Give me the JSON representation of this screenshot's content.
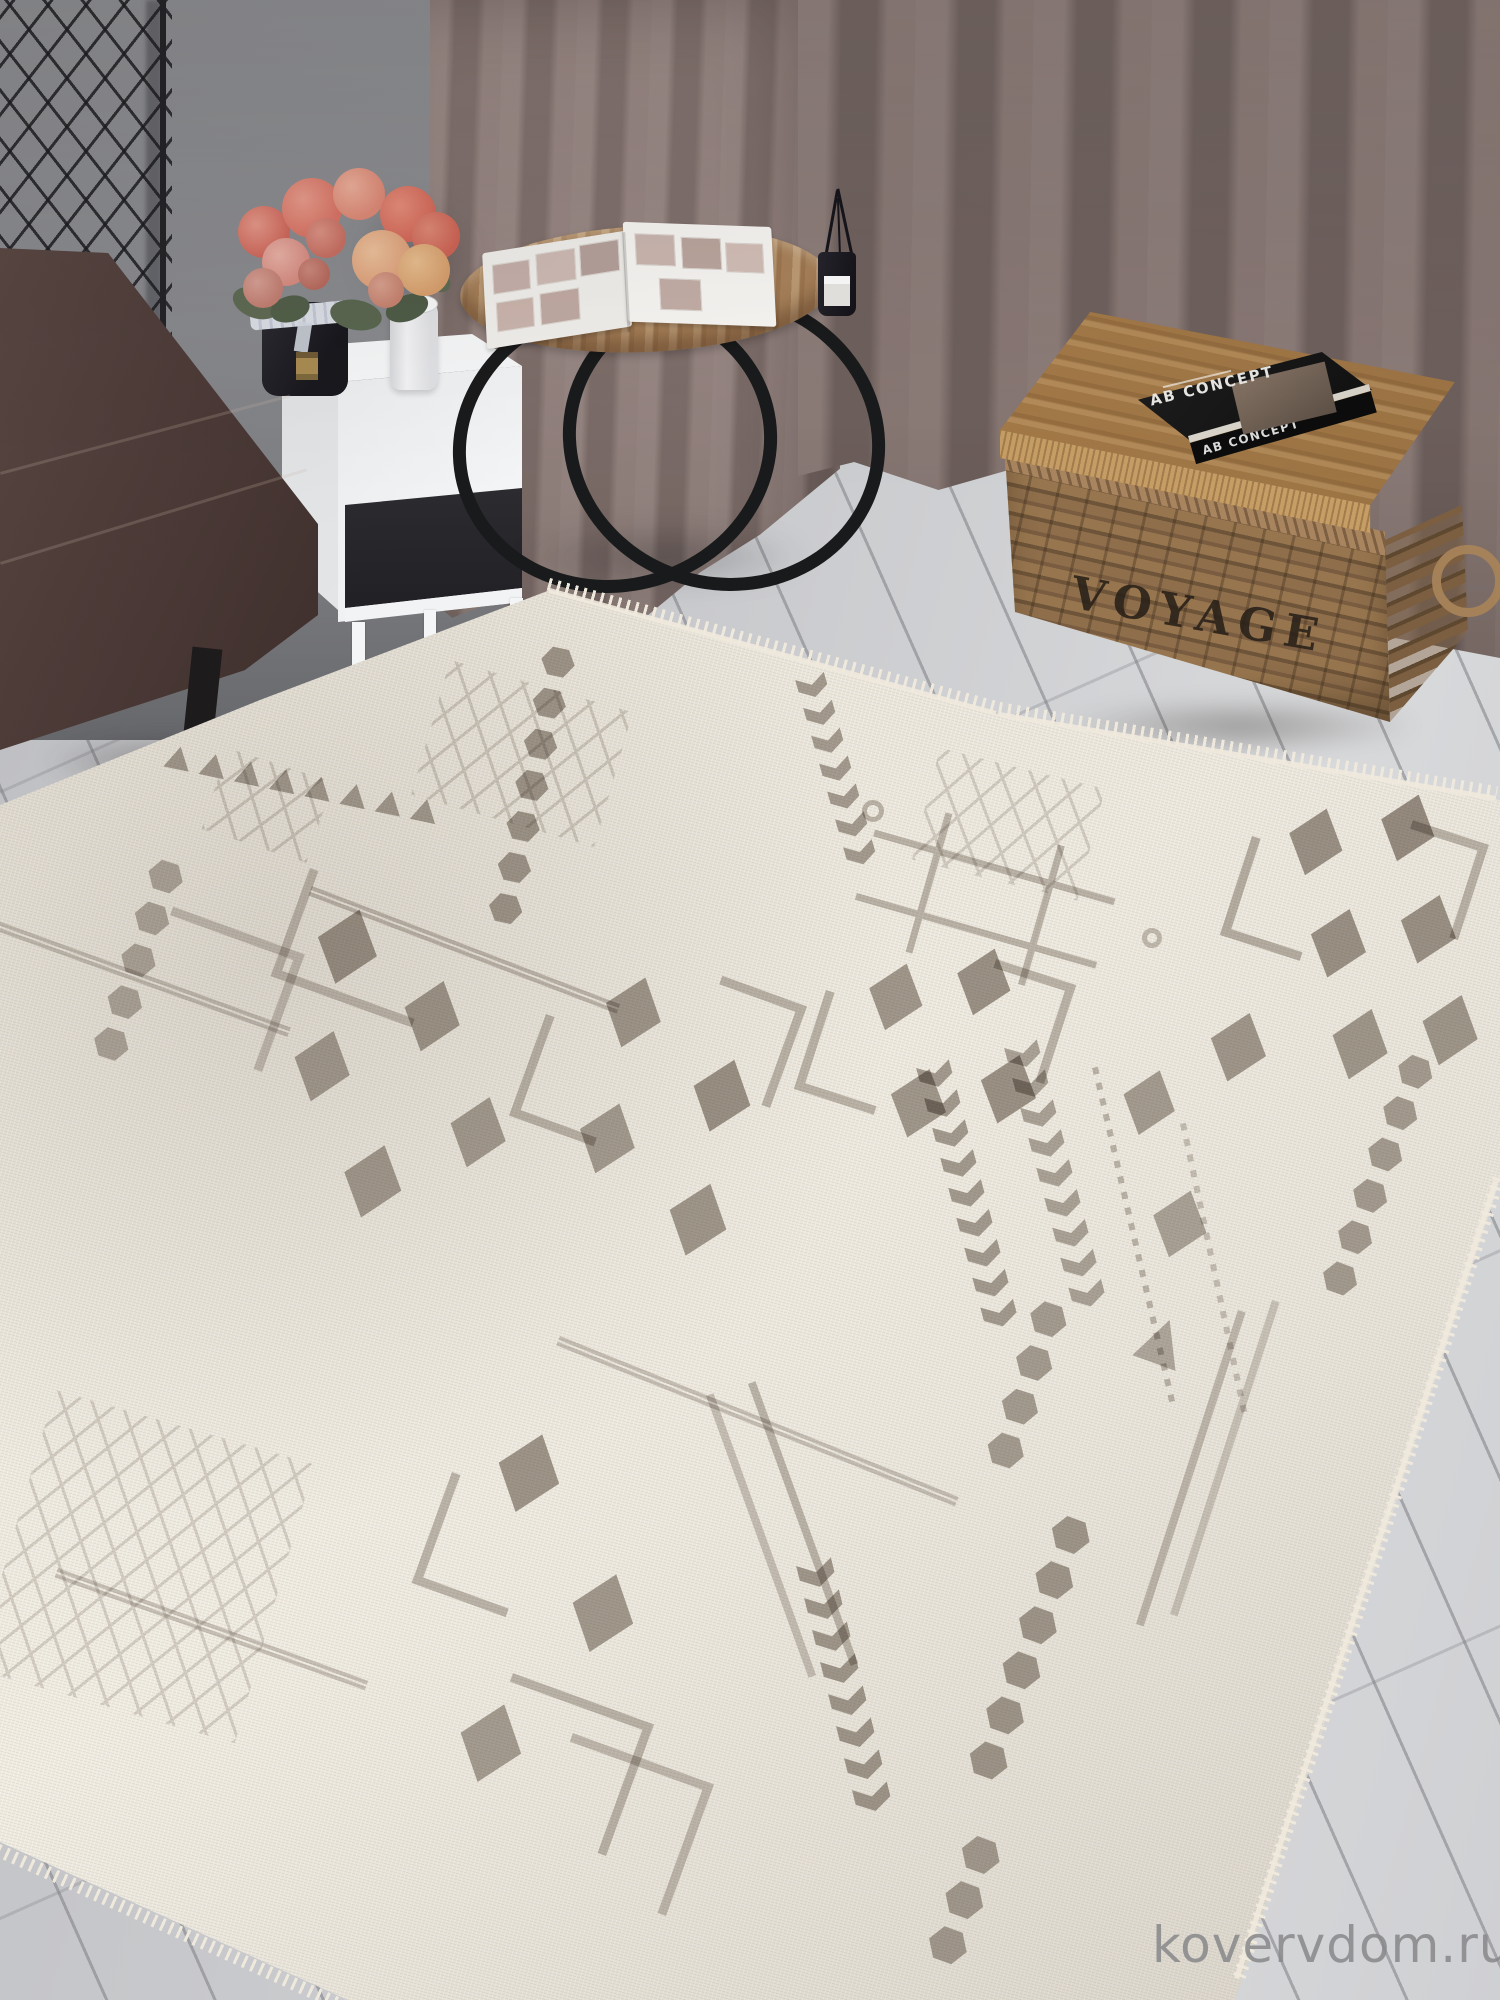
{
  "watermark": {
    "text": "kovervdom.ru"
  },
  "objects": {
    "basket": {
      "label": "VOYAGE"
    },
    "book": {
      "cover_title": "AB CONCEPT",
      "spine_title": "AB CONCEPT"
    }
  },
  "colors": {
    "motif": "#8f857c",
    "rug_base": "#e9e4d9",
    "fringe": "#efe9dd",
    "floor": "#c7c8cb",
    "wall": "#8d8e92",
    "grid_line": "#26262a",
    "curtain": "#8e7c78",
    "curtain_dark": "#6f605c",
    "sofa": "#4e3c39",
    "table_wood": "#a8825a",
    "metal": "#1a1a1c",
    "nightstand": "#f3f4f6",
    "basket_wicker": "#8c6c4a",
    "lid_wood": "#9b7344",
    "lid_edge": "#c59d65",
    "book_black": "#131313",
    "book_text": "#e8e6e2",
    "voyage_ink": "#2e2720",
    "flower_coral": "#d96b5c",
    "leaf_green": "#56644c",
    "vase_black": "#201f26",
    "watermark": "#88888a"
  },
  "rug": {
    "style": "cream flatweave with grey berber geometric motifs",
    "motifs": [
      {
        "t": "hex",
        "x": 578,
        "y": 650,
        "r": 102,
        "n": 7,
        "s": 32,
        "o": 0.75
      },
      {
        "t": "lattice",
        "x": 450,
        "y": 660,
        "w": 190,
        "h": 140,
        "r": 16,
        "o": 0.3
      },
      {
        "t": "chevcol",
        "x": 795,
        "y": 680,
        "r": -16,
        "n": 7,
        "s": 30,
        "ar": 0.72,
        "o": 0.7
      },
      {
        "t": "lattice",
        "x": 940,
        "y": 748,
        "w": 170,
        "h": 115,
        "r": 14,
        "o": 0.28
      },
      {
        "t": "hash",
        "x": 885,
        "y": 795,
        "w": 250,
        "h": 145,
        "r": 16,
        "o": 0.5
      },
      {
        "t": "ring",
        "x": 862,
        "y": 800,
        "w": 22,
        "h": 22,
        "o": 0.5
      },
      {
        "t": "ring",
        "x": 1142,
        "y": 928,
        "w": 20,
        "h": 20,
        "o": 0.45
      },
      {
        "t": "dia",
        "x": 1300,
        "y": 800,
        "w": 56,
        "h": 70,
        "r": 18,
        "o": 0.8
      },
      {
        "t": "dia",
        "x": 1392,
        "y": 786,
        "w": 56,
        "h": 70,
        "r": 18,
        "o": 0.85
      },
      {
        "t": "dia",
        "x": 1322,
        "y": 900,
        "w": 58,
        "h": 72,
        "r": 18,
        "o": 0.8
      },
      {
        "t": "dia",
        "x": 1412,
        "y": 886,
        "w": 58,
        "h": 72,
        "r": 18,
        "o": 0.8
      },
      {
        "t": "dia",
        "x": 1344,
        "y": 1000,
        "w": 58,
        "h": 74,
        "r": 18,
        "o": 0.75
      },
      {
        "t": "dia",
        "x": 1434,
        "y": 986,
        "w": 58,
        "h": 74,
        "r": 18,
        "o": 0.75
      },
      {
        "t": "dia",
        "x": 1222,
        "y": 1004,
        "w": 58,
        "h": 72,
        "r": 18,
        "o": 0.75
      },
      {
        "t": "L",
        "x": 1252,
        "y": 836,
        "w": 84,
        "h": 104,
        "r": 18,
        "o": 0.55
      },
      {
        "t": "L",
        "x": 1458,
        "y": 940,
        "w": 80,
        "h": 100,
        "r": 198,
        "o": 0.5
      },
      {
        "t": "dia",
        "x": 880,
        "y": 955,
        "w": 56,
        "h": 70,
        "r": 18,
        "o": 0.75
      },
      {
        "t": "dia",
        "x": 968,
        "y": 940,
        "w": 56,
        "h": 70,
        "r": 18,
        "o": 0.8
      },
      {
        "t": "dia",
        "x": 902,
        "y": 1060,
        "w": 58,
        "h": 72,
        "r": 18,
        "o": 0.75
      },
      {
        "t": "dia",
        "x": 992,
        "y": 1046,
        "w": 58,
        "h": 72,
        "r": 18,
        "o": 0.8
      },
      {
        "t": "L",
        "x": 826,
        "y": 990,
        "w": 84,
        "h": 104,
        "r": 18,
        "o": 0.5
      },
      {
        "t": "L",
        "x": 1044,
        "y": 1084,
        "w": 84,
        "h": 104,
        "r": 198,
        "o": 0.5
      },
      {
        "t": "trirow",
        "x": 168,
        "y": 744,
        "r": 12,
        "n": 8,
        "s": 26,
        "ar": 0.9,
        "o": 0.7
      },
      {
        "t": "hex",
        "x": 188,
        "y": 866,
        "r": 108,
        "n": 5,
        "s": 34,
        "o": 0.6
      },
      {
        "t": "dline",
        "x": -10,
        "y": 918,
        "w": 320,
        "h": 10,
        "r": 20,
        "o": 0.4
      },
      {
        "t": "lattice",
        "x": 228,
        "y": 748,
        "w": 110,
        "h": 85,
        "r": 18,
        "o": 0.3
      },
      {
        "t": "L",
        "x": 310,
        "y": 868,
        "w": 150,
        "h": 115,
        "r": 20,
        "o": 0.45
      },
      {
        "t": "dia",
        "x": 330,
        "y": 900,
        "w": 62,
        "h": 78,
        "r": 18,
        "o": 0.8
      },
      {
        "t": "dia",
        "x": 306,
        "y": 1022,
        "w": 58,
        "h": 74,
        "r": 18,
        "o": 0.7
      },
      {
        "t": "dia",
        "x": 416,
        "y": 972,
        "w": 58,
        "h": 74,
        "r": 18,
        "o": 0.75
      },
      {
        "t": "dia",
        "x": 356,
        "y": 1136,
        "w": 60,
        "h": 76,
        "r": 18,
        "o": 0.72
      },
      {
        "t": "dia",
        "x": 462,
        "y": 1088,
        "w": 58,
        "h": 74,
        "r": 18,
        "o": 0.7
      },
      {
        "t": "L",
        "x": 262,
        "y": 1072,
        "w": 140,
        "h": 125,
        "r": 200,
        "o": 0.4
      },
      {
        "t": "dline",
        "x": 312,
        "y": 886,
        "w": 330,
        "h": 10,
        "r": 21,
        "o": 0.45
      },
      {
        "t": "dia",
        "x": 618,
        "y": 968,
        "w": 58,
        "h": 74,
        "r": 19,
        "o": 0.75
      },
      {
        "t": "dia",
        "x": 706,
        "y": 1050,
        "w": 60,
        "h": 76,
        "r": 19,
        "o": 0.8
      },
      {
        "t": "dia",
        "x": 592,
        "y": 1094,
        "w": 58,
        "h": 74,
        "r": 19,
        "o": 0.7
      },
      {
        "t": "dia",
        "x": 682,
        "y": 1174,
        "w": 60,
        "h": 76,
        "r": 19,
        "o": 0.75
      },
      {
        "t": "L",
        "x": 546,
        "y": 1014,
        "w": 90,
        "h": 108,
        "r": 20,
        "o": 0.5
      },
      {
        "t": "L",
        "x": 770,
        "y": 1108,
        "w": 90,
        "h": 108,
        "r": 200,
        "o": 0.5
      },
      {
        "t": "chevcol",
        "x": 916,
        "y": 1068,
        "r": -15,
        "n": 9,
        "s": 34,
        "ar": 0.72,
        "o": 0.72
      },
      {
        "t": "chevcol",
        "x": 1004,
        "y": 1048,
        "r": -15,
        "n": 9,
        "s": 34,
        "ar": 0.72,
        "o": 0.65
      },
      {
        "t": "dots",
        "x": 1092,
        "y": 1068,
        "w": 6,
        "h": 350,
        "r": -13,
        "o": 0.5
      },
      {
        "t": "dia",
        "x": 1134,
        "y": 1062,
        "w": 54,
        "h": 68,
        "r": 18,
        "o": 0.7
      },
      {
        "t": "dia",
        "x": 1164,
        "y": 1182,
        "w": 56,
        "h": 70,
        "r": 18,
        "o": 0.65
      },
      {
        "t": "hex",
        "x": 1438,
        "y": 1062,
        "r": 110,
        "n": 6,
        "s": 34,
        "o": 0.7
      },
      {
        "t": "hex",
        "x": 1072,
        "y": 1308,
        "r": 108,
        "n": 4,
        "s": 36,
        "o": 0.7
      },
      {
        "t": "line",
        "x": 1238,
        "y": 1310,
        "w": 8,
        "h": 330,
        "r": 18,
        "o": 0.45
      },
      {
        "t": "line",
        "x": 1272,
        "y": 1300,
        "w": 8,
        "h": 330,
        "r": 18,
        "o": 0.35
      },
      {
        "t": "dia",
        "x": 1436,
        "y": 1378,
        "w": 56,
        "h": 90,
        "r": 12,
        "o": 0.7
      },
      {
        "t": "dia",
        "x": 512,
        "y": 1424,
        "w": 64,
        "h": 82,
        "r": 19,
        "o": 0.78
      },
      {
        "t": "L",
        "x": 452,
        "y": 1472,
        "w": 100,
        "h": 118,
        "r": 20,
        "o": 0.5
      },
      {
        "t": "dia",
        "x": 586,
        "y": 1564,
        "w": 64,
        "h": 82,
        "r": 19,
        "o": 0.74
      },
      {
        "t": "dia",
        "x": 474,
        "y": 1694,
        "w": 64,
        "h": 82,
        "r": 19,
        "o": 0.7
      },
      {
        "t": "lattice",
        "x": 55,
        "y": 1390,
        "w": 270,
        "h": 290,
        "r": 16,
        "o": 0.28
      },
      {
        "t": "dline",
        "x": 58,
        "y": 1568,
        "w": 330,
        "h": 10,
        "r": 20,
        "o": 0.4
      },
      {
        "t": "trirow",
        "x": 1148,
        "y": 1312,
        "r": 20,
        "n": 1,
        "s": 46,
        "ar": 1,
        "o": 0.6
      },
      {
        "t": "line",
        "x": 748,
        "y": 1384,
        "w": 8,
        "h": 300,
        "r": -20,
        "o": 0.5
      },
      {
        "t": "line",
        "x": 706,
        "y": 1396,
        "w": 8,
        "h": 300,
        "r": -20,
        "o": 0.4
      },
      {
        "t": "chevcol",
        "x": 796,
        "y": 1566,
        "r": -14,
        "n": 8,
        "s": 36,
        "ar": 0.72,
        "o": 0.75
      },
      {
        "t": "hex",
        "x": 1096,
        "y": 1524,
        "r": 110,
        "n": 6,
        "s": 38,
        "o": 0.75
      },
      {
        "t": "hex",
        "x": 1006,
        "y": 1844,
        "r": 110,
        "n": 3,
        "s": 38,
        "o": 0.7
      },
      {
        "t": "L",
        "x": 606,
        "y": 1856,
        "w": 150,
        "h": 140,
        "r": 200,
        "o": 0.5
      },
      {
        "t": "L",
        "x": 666,
        "y": 1916,
        "w": 150,
        "h": 140,
        "r": 200,
        "o": 0.45
      },
      {
        "t": "dline",
        "x": 560,
        "y": 1336,
        "w": 430,
        "h": 10,
        "r": 22,
        "o": 0.4
      },
      {
        "t": "dots",
        "x": 1180,
        "y": 1124,
        "w": 6,
        "h": 300,
        "r": -12,
        "o": 0.4
      }
    ]
  }
}
